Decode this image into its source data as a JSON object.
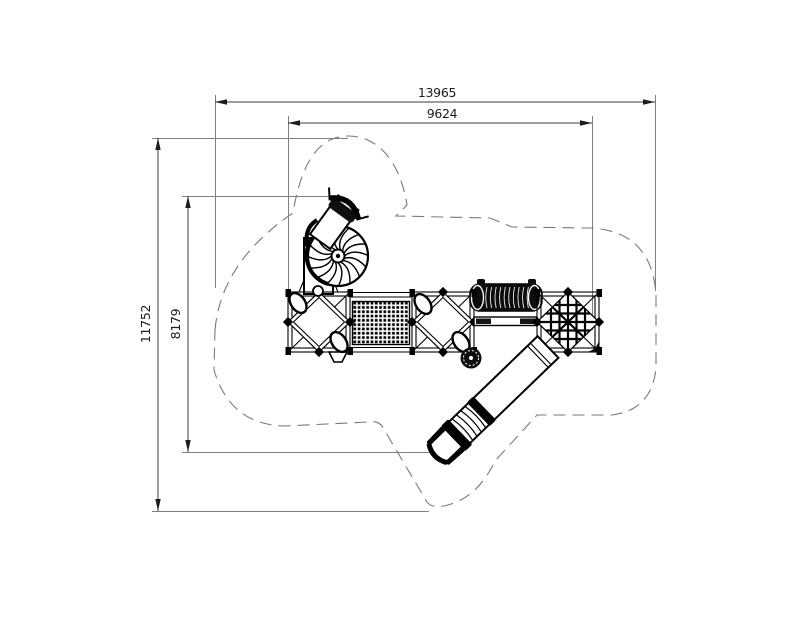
{
  "drawing": {
    "dimensions": {
      "total_width": {
        "value": "13965"
      },
      "structure_width": {
        "value": "9624"
      },
      "total_height": {
        "value": "11752"
      },
      "structure_height": {
        "value": "8179"
      }
    },
    "colors": {
      "line_black": "#000000",
      "dim_gray": "#7f7f7f",
      "zone_dash_gray": "#7a7a7a",
      "background": "#ffffff"
    }
  }
}
